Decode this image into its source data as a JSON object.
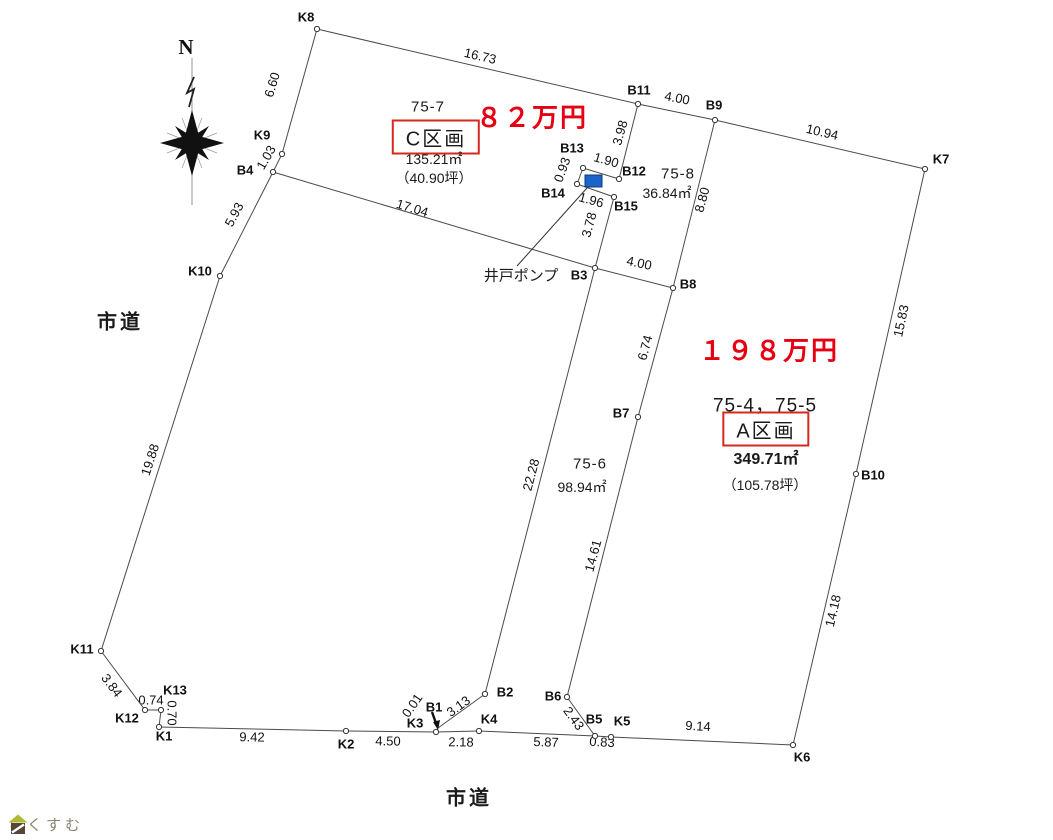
{
  "diagram": {
    "compass_label": "N",
    "road_labels": [
      {
        "text": "市道",
        "x": 120,
        "y": 320
      },
      {
        "text": "市道",
        "x": 469,
        "y": 796
      }
    ],
    "well_pump": {
      "label": "井戸ポンプ",
      "label_x": 521,
      "label_y": 275,
      "rect": {
        "x": 585,
        "y": 175,
        "w": 17,
        "h": 12
      },
      "leader": {
        "x1": 517,
        "y1": 266,
        "x2": 587,
        "y2": 188
      }
    },
    "b1_arrow": {
      "x1": 432,
      "y1": 712,
      "x2": 437,
      "y2": 726
    },
    "points": [
      {
        "id": "K8",
        "x": 317,
        "y": 29,
        "lx": 306,
        "ly": 18
      },
      {
        "id": "K9",
        "x": 282,
        "y": 154,
        "lx": 262,
        "ly": 136
      },
      {
        "id": "B4",
        "x": 273,
        "y": 172,
        "lx": 245,
        "ly": 171
      },
      {
        "id": "K10",
        "x": 220,
        "y": 276,
        "lx": 200,
        "ly": 272
      },
      {
        "id": "K11",
        "x": 101,
        "y": 651,
        "lx": 82,
        "ly": 650
      },
      {
        "id": "K12",
        "x": 145,
        "y": 710,
        "lx": 127,
        "ly": 719
      },
      {
        "id": "K13",
        "x": 161,
        "y": 710,
        "lx": 175,
        "ly": 691
      },
      {
        "id": "K1",
        "x": 159,
        "y": 727,
        "lx": 164,
        "ly": 737
      },
      {
        "id": "K2",
        "x": 346,
        "y": 731,
        "lx": 346,
        "ly": 745
      },
      {
        "id": "K3",
        "x": 436,
        "y": 732,
        "lx": 415,
        "ly": 724
      },
      {
        "id": "B1",
        "x": 438,
        "y": 728,
        "lx": 434,
        "ly": 708,
        "circle": false
      },
      {
        "id": "K4",
        "x": 479,
        "y": 731,
        "lx": 489,
        "ly": 720
      },
      {
        "id": "B2",
        "x": 485,
        "y": 694,
        "lx": 505,
        "ly": 693
      },
      {
        "id": "B6",
        "x": 567,
        "y": 697,
        "lx": 553,
        "ly": 697
      },
      {
        "id": "B5",
        "x": 595,
        "y": 736,
        "lx": 594,
        "ly": 720
      },
      {
        "id": "K5",
        "x": 611,
        "y": 737,
        "lx": 622,
        "ly": 722
      },
      {
        "id": "K6",
        "x": 793,
        "y": 745,
        "lx": 802,
        "ly": 758
      },
      {
        "id": "B10",
        "x": 856,
        "y": 474,
        "lx": 873,
        "ly": 476
      },
      {
        "id": "K7",
        "x": 925,
        "y": 169,
        "lx": 941,
        "ly": 160
      },
      {
        "id": "B9",
        "x": 715,
        "y": 120,
        "lx": 714,
        "ly": 106
      },
      {
        "id": "B11",
        "x": 638,
        "y": 104,
        "lx": 639,
        "ly": 91
      },
      {
        "id": "B12",
        "x": 619,
        "y": 179,
        "lx": 634,
        "ly": 172
      },
      {
        "id": "B13",
        "x": 583,
        "y": 168,
        "lx": 572,
        "ly": 149
      },
      {
        "id": "B14",
        "x": 577,
        "y": 184,
        "lx": 553,
        "ly": 194
      },
      {
        "id": "B15",
        "x": 614,
        "y": 197,
        "lx": 626,
        "ly": 207
      },
      {
        "id": "B3",
        "x": 595,
        "y": 268,
        "lx": 579,
        "ly": 276
      },
      {
        "id": "B8",
        "x": 673,
        "y": 288,
        "lx": 688,
        "ly": 285
      },
      {
        "id": "B7",
        "x": 638,
        "y": 417,
        "lx": 621,
        "ly": 414
      }
    ],
    "segments": [
      {
        "a": "K8",
        "b": "B11",
        "len": "16.73",
        "lx": 480,
        "ly": 57,
        "rot": 13
      },
      {
        "a": "B11",
        "b": "B9",
        "len": "4.00",
        "lx": 677,
        "ly": 99,
        "rot": 11
      },
      {
        "a": "B9",
        "b": "K7",
        "len": "10.94",
        "lx": 822,
        "ly": 133,
        "rot": 13
      },
      {
        "a": "K7",
        "b": "B10",
        "len": "15.83",
        "lx": 902,
        "ly": 321,
        "rot": -78
      },
      {
        "a": "B10",
        "b": "K6",
        "len": "14.18",
        "lx": 834,
        "ly": 611,
        "rot": -77
      },
      {
        "a": "K5",
        "b": "K6",
        "len": "9.14",
        "lx": 698,
        "ly": 727,
        "rot": 3
      },
      {
        "a": "B5",
        "b": "K5",
        "len": "0.83",
        "lx": 602,
        "ly": 743,
        "rot": 3
      },
      {
        "a": "K4",
        "b": "B5",
        "len": "5.87",
        "lx": 546,
        "ly": 743,
        "rot": 2
      },
      {
        "a": "K3",
        "b": "K4",
        "len": "2.18",
        "lx": 461,
        "ly": 743,
        "rot": 1
      },
      {
        "a": "K2",
        "b": "K3",
        "len": "4.50",
        "lx": 388,
        "ly": 742,
        "rot": 1
      },
      {
        "a": "K1",
        "b": "K2",
        "len": "9.42",
        "lx": 252,
        "ly": 738,
        "rot": 1
      },
      {
        "a": "K13",
        "b": "K1",
        "len": "0.70",
        "lx": 171,
        "ly": 713,
        "rot": 90
      },
      {
        "a": "K12",
        "b": "K13",
        "len": "0.74",
        "lx": 151,
        "ly": 701,
        "rot": 0
      },
      {
        "a": "K11",
        "b": "K12",
        "len": "3.84",
        "lx": 111,
        "ly": 686,
        "rot": 53
      },
      {
        "a": "K10",
        "b": "K11",
        "len": "19.88",
        "lx": 151,
        "ly": 460,
        "rot": -72
      },
      {
        "a": "B4",
        "b": "K10",
        "len": "5.93",
        "lx": 235,
        "ly": 215,
        "rot": -62
      },
      {
        "a": "K9",
        "b": "B4",
        "len": "1.03",
        "lx": 267,
        "ly": 158,
        "rot": -60
      },
      {
        "a": "K8",
        "b": "K9",
        "len": "6.60",
        "lx": 273,
        "ly": 85,
        "rot": -73
      },
      {
        "a": "B4",
        "b": "B3",
        "len": "17.04",
        "lx": 412,
        "ly": 209,
        "rot": 17
      },
      {
        "a": "B11",
        "b": "B12",
        "len": "3.98",
        "lx": 621,
        "ly": 133,
        "rot": -74
      },
      {
        "a": "B12",
        "b": "B13",
        "len": "1.90",
        "lx": 606,
        "ly": 161,
        "rot": 16
      },
      {
        "a": "B13",
        "b": "B14",
        "len": "0.93",
        "lx": 563,
        "ly": 170,
        "rot": -70
      },
      {
        "a": "B14",
        "b": "B15",
        "len": "1.96",
        "lx": 591,
        "ly": 201,
        "rot": 16
      },
      {
        "a": "B15",
        "b": "B3",
        "len": "3.78",
        "lx": 590,
        "ly": 225,
        "rot": -75
      },
      {
        "a": "B3",
        "b": "B8",
        "len": "4.00",
        "lx": 639,
        "ly": 264,
        "rot": 12
      },
      {
        "a": "B9",
        "b": "B8",
        "len": "8.80",
        "lx": 703,
        "ly": 200,
        "rot": -75
      },
      {
        "a": "B8",
        "b": "B7",
        "len": "6.74",
        "lx": 646,
        "ly": 348,
        "rot": -75
      },
      {
        "a": "B7",
        "b": "B6",
        "len": "14.61",
        "lx": 594,
        "ly": 556,
        "rot": -75
      },
      {
        "a": "B6",
        "b": "B5",
        "len": "2.43",
        "lx": 573,
        "ly": 719,
        "rot": 54
      },
      {
        "a": "B3",
        "b": "B2",
        "len": "22.28",
        "lx": 532,
        "ly": 475,
        "rot": -75
      },
      {
        "a": "B2",
        "b": "B1",
        "len": "3.13",
        "lx": 459,
        "ly": 707,
        "rot": -36
      },
      {
        "a": "B1",
        "b": "K3",
        "len": "0.01",
        "lx": 413,
        "ly": 706,
        "rot": -55
      }
    ]
  },
  "parcels": [
    {
      "lot": "75-7",
      "name": "C区画",
      "area_m2": "135.21㎡",
      "area_tsubo": "（40.90坪）",
      "price": "８２万円"
    },
    {
      "lot": "75-8",
      "area_m2": "36.84㎡"
    },
    {
      "lot": "75-6",
      "area_m2": "98.94㎡"
    },
    {
      "lot": "75-4，75-5",
      "name": "A区画",
      "area_m2": "349.71㎡",
      "area_tsubo": "（105.78坪）",
      "price": "１９８万円"
    }
  ],
  "logo": {
    "text": "らくすむ"
  },
  "colors": {
    "price_red": "#e60012",
    "box_red": "#d5281e",
    "pump_blue": "#1a63c8",
    "line": "#4a4a4a"
  }
}
